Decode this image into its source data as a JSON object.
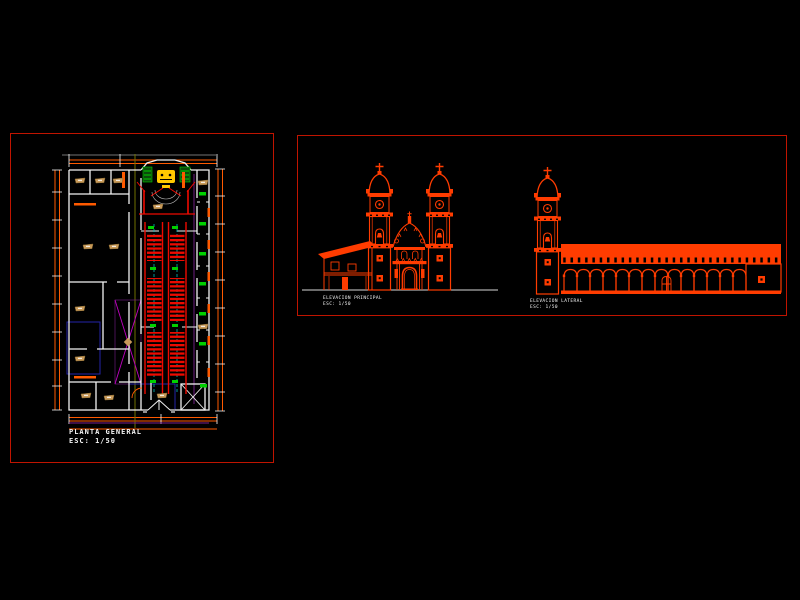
{
  "window": {
    "background": "#000000",
    "width": 800,
    "height": 600
  },
  "colors": {
    "bg": "#000000",
    "border": "#c01400",
    "orange": "#ff3c00",
    "dim": "#ff5a00",
    "wall": "#f2f2f2",
    "gray": "#9a9a9a",
    "pew": "#ee0a00",
    "green": "#00d000",
    "darkgreen": "#0c4a0c",
    "yellow": "#ffc800",
    "tan": "#c89a5a",
    "tandark": "#8a6a30",
    "magenta": "#c000c0",
    "purple": "#7a1f8e",
    "navy": "#2424a8",
    "teal": "#00b8b8",
    "olive": "#707000",
    "text": "#f5f5f5"
  },
  "plan_sheet": {
    "title": "PLANTA GENERAL",
    "scale_label": "ESC: 1/50"
  },
  "elevation_sheet": {
    "front_elevation": {
      "caption": "ELEVACION PRINCIPAL",
      "scale_label": "ESC: 1/50"
    },
    "side_elevation": {
      "caption": "ELEVACION LATERAL",
      "scale_label": "ESC: 1/50"
    }
  }
}
